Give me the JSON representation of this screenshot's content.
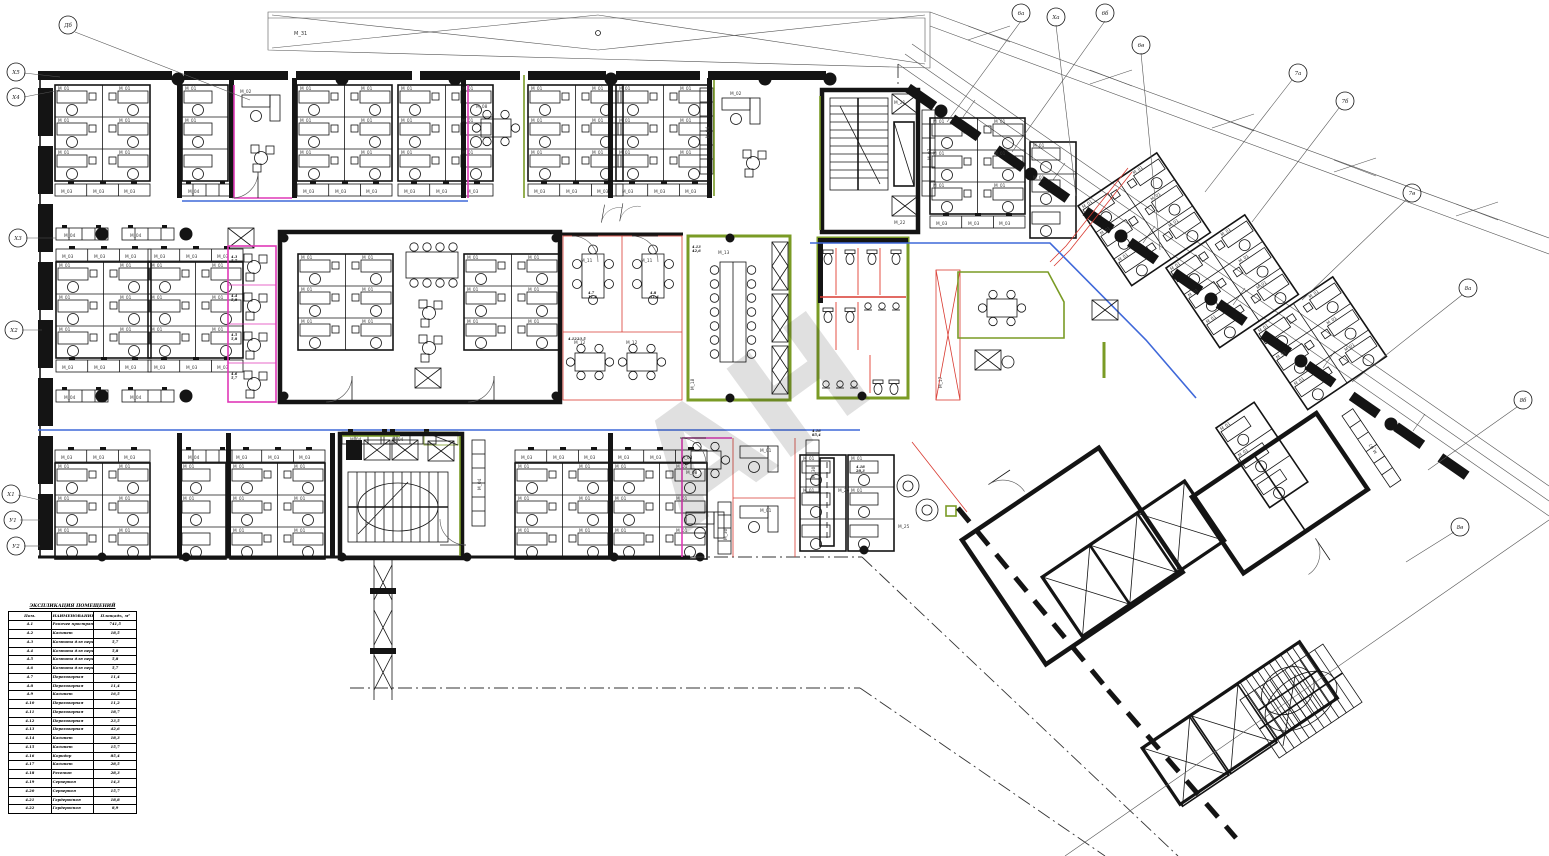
{
  "watermark": "АН",
  "labels": {
    "canopy": "M_31",
    "desk": "M_01",
    "office": "M_02",
    "cabinet": "M_03",
    "locker": "M_04",
    "locker_top": "M_07",
    "table": "M_08",
    "meeting_a": "M_11",
    "meeting_b": "M_12",
    "conference": "M_13",
    "shaft": "M_17",
    "conf_glass": "M_18",
    "core_a": "M_21",
    "core_b": "M_22",
    "lounge": "M_25",
    "counter": "M_26",
    "storage": "M_30"
  },
  "grid": [
    "Дб",
    "Х5",
    "Х4",
    "Х3",
    "Х2",
    "Х1",
    "У1",
    "У2",
    "6а",
    "Ха",
    "6б",
    "6в",
    "7а",
    "7б",
    "7в",
    "8а",
    "8б",
    "8в"
  ],
  "tags": [
    {
      "r": "4.3",
      "a": "5,7"
    },
    {
      "r": "4.4",
      "a": "5,8"
    },
    {
      "r": "4.5",
      "a": "5,8"
    },
    {
      "r": "4.6",
      "a": "5,7"
    },
    {
      "r": "4.7",
      "a": "11,4"
    },
    {
      "r": "4.8",
      "a": "11,4"
    },
    {
      "r": "4.12",
      "a": "23,5"
    },
    {
      "r": "4.13",
      "a": "42,6"
    },
    {
      "r": "4.16",
      "a": "85,4"
    },
    {
      "r": "4.18",
      "a": "28,3"
    }
  ],
  "schedule": {
    "title": "ЭКСПЛИКАЦИЯ ПОМЕЩЕНИЙ",
    "headers": [
      "Пом.",
      "НАИМЕНОВАНИЕ",
      "Площадь, м²"
    ],
    "rows": [
      {
        "num": "4.1",
        "name": "Рабочее пространство \"опен спейс\"",
        "area": "741,5"
      },
      {
        "num": "4.2",
        "name": "Кабинет",
        "area": "18,5"
      },
      {
        "num": "4.3",
        "name": "Комната для переговоров по телефону",
        "area": "5,7"
      },
      {
        "num": "4.4",
        "name": "Комната для переговоров по телефону",
        "area": "5,8"
      },
      {
        "num": "4.5",
        "name": "Комната для переговоров по телефону",
        "area": "5,8"
      },
      {
        "num": "4.6",
        "name": "Комната для переговоров по телефону",
        "area": "5,7"
      },
      {
        "num": "4.7",
        "name": "Переговорная",
        "area": "11,4"
      },
      {
        "num": "4.8",
        "name": "Переговорная",
        "area": "11,4"
      },
      {
        "num": "4.9",
        "name": "Кабинет",
        "area": "16,5"
      },
      {
        "num": "4.10",
        "name": "Переговорная",
        "area": "11,2"
      },
      {
        "num": "4.11",
        "name": "Переговорная",
        "area": "18,7"
      },
      {
        "num": "4.12",
        "name": "Переговорная",
        "area": "23,5"
      },
      {
        "num": "4.13",
        "name": "Переговорная",
        "area": "42,6"
      },
      {
        "num": "4.14",
        "name": "Кабинет",
        "area": "18,3"
      },
      {
        "num": "4.15",
        "name": "Кабинет",
        "area": "15,7"
      },
      {
        "num": "4.16",
        "name": "Коридор",
        "area": "85,4"
      },
      {
        "num": "4.17",
        "name": "Кабинет",
        "area": "28,5"
      },
      {
        "num": "4.18",
        "name": "Ресепшн",
        "area": "28,3"
      },
      {
        "num": "4.19",
        "name": "Серверная",
        "area": "14,3"
      },
      {
        "num": "4.20",
        "name": "Серверная",
        "area": "15,7"
      },
      {
        "num": "4.21",
        "name": "Гардеробная",
        "area": "18,8"
      },
      {
        "num": "4.22",
        "name": "Гардеробная",
        "area": "8,9"
      }
    ]
  },
  "colors": {
    "wall": "#141414",
    "glass_green": "#7a9b25",
    "partition_magenta": "#df39b7",
    "partition_red": "#d93a31",
    "corridor_blue": "#3f68d9"
  }
}
